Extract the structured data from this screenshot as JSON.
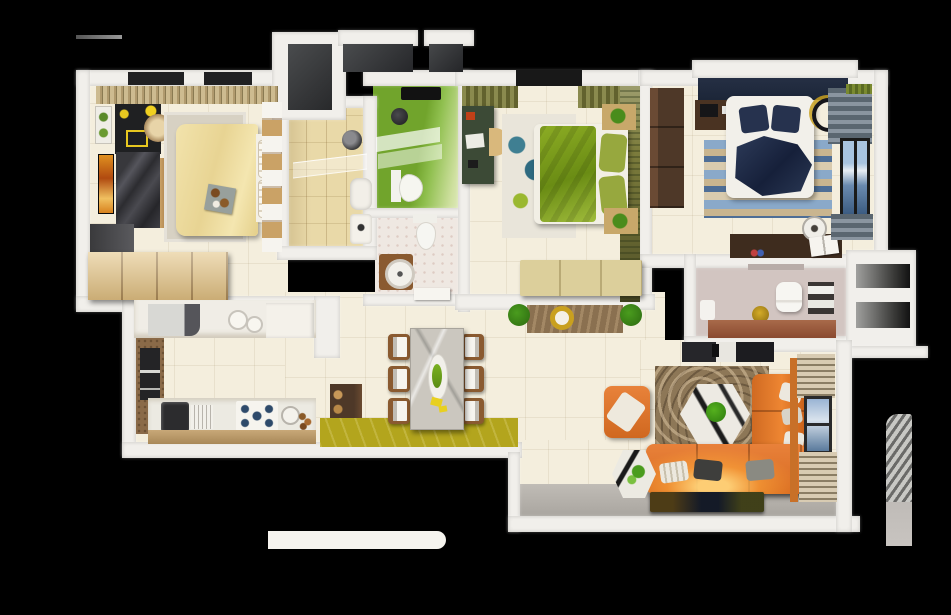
{
  "scene": {
    "kind": "3d-apartment-floorplan-top-view",
    "background_color": "#000000",
    "canvas": {
      "width": 951,
      "height": 615
    },
    "visible_text": "none"
  },
  "palette": {
    "bg": "#000000",
    "wall": "#f1efeb",
    "floor-cream": "#f4eedd",
    "floor-gray": "#b2aeaa",
    "olive-rug": "#b3a51d",
    "slab-dark": "#3b3d3f",
    "navy-slab": "#1c2638",
    "bed1": "#efdfa3",
    "rug1": "#d7d1c3",
    "wood-light": "#e6cb92",
    "wood-tan": "#caa266",
    "wood-mid": "#8a5a30",
    "wood-dark": "#4e3828",
    "wood-deep": "#3e2c1e",
    "black-furn": "#1f2022",
    "marble-dark": "#333336",
    "tv-orange": "#d8821e",
    "bath-tan": "#e9d9a8",
    "green-wall": "#71a42c",
    "toilet-floor": "#efe8e2",
    "desk-green": "#3c4a36",
    "blanket-green": "#7d9c1e",
    "head-olive": "#7c7c3c",
    "bench-khaki": "#dccf9b",
    "nightstand-tan": "#c8a86a",
    "navy-blanket": "#232f4a",
    "curtain-gray": "#76818b",
    "sky-blue": "#8fb0d6",
    "mauve": "#d2c5c1",
    "copper": "#9a5c40",
    "gold": "#c9a01e",
    "sofa-orange": "#e2772a",
    "glow": "#ffb347",
    "living-rug": "#8d7757",
    "marble-white": "#edeae3",
    "white-soft": "#f6f4ef",
    "counter-white": "#f0ede6",
    "curtain-beige": "#cdbb90",
    "blind-tan": "#d8cbb2",
    "plant": "#3f9c1c"
  },
  "rooms": [
    {
      "id": "bedroom-1",
      "position": "top-left",
      "floor": "cream-tile",
      "furniture": [
        "striped-curtain",
        "window-panes",
        "picture-frames",
        "black-dresser",
        "rattan-lamp",
        "marble-tv-unit",
        "wall-tv",
        "area-rug",
        "double-bed-cream",
        "headboard-pillows",
        "breakfast-tray",
        "door-opening",
        "wood-wardrobe",
        "towel-shelf-column"
      ]
    },
    {
      "id": "ensuite-bathroom",
      "position": "top-center-left",
      "floor": "tan-tile",
      "furniture": [
        "shower-head",
        "glass-shelf",
        "bathtub",
        "washbasin"
      ]
    },
    {
      "id": "green-bathroom",
      "position": "top-center",
      "floor": "green-gradient",
      "furniture": [
        "ceiling-vent",
        "round-basin",
        "glass-shelves",
        "toilet"
      ]
    },
    {
      "id": "wc-room",
      "position": "center",
      "floor": "speckled-white",
      "furniture": [
        "toilet",
        "wood-vanity-round-basin",
        "door-leaf"
      ]
    },
    {
      "id": "master-bedroom",
      "position": "top-center-right",
      "floor": "cream-tile",
      "furniture": [
        "curtain-left",
        "window-pane",
        "curtain-right",
        "green-desk",
        "desk-chair",
        "abstract-teal-rug",
        "bed-green-blanket",
        "olive-pillows",
        "nightstand-top-flowers",
        "nightstand-bottom-flowers",
        "textured-headboard-wall",
        "storage-bench"
      ]
    },
    {
      "id": "bedroom-3",
      "position": "top-right",
      "floor": "cream-tile",
      "furniture": [
        "navy-headboard-ledge",
        "dark-wardrobe",
        "study-desk",
        "bed-navy-blanket",
        "navy-pillows",
        "striped-blue-rug",
        "ceiling-fan",
        "gray-curtain-top",
        "side-window-art",
        "writing-desk",
        "kettle",
        "open-book",
        "gray-curtain-bottom",
        "green-curtain-sliver"
      ]
    },
    {
      "id": "bathroom-2",
      "position": "right-center",
      "floor": "mauve",
      "furniture": [
        "wall-mirror",
        "toilet",
        "gold-plant",
        "towel-rack",
        "washbasin",
        "copper-floor-strip"
      ]
    },
    {
      "id": "utility-shaft",
      "position": "right-edge",
      "floor": "dark-void",
      "furniture": [
        "duct-opening-upper",
        "duct-opening-lower"
      ]
    },
    {
      "id": "kitchen",
      "position": "bottom-left",
      "floor": "cream-tile",
      "furniture": [
        "upper-counter",
        "built-in-appliance",
        "plates",
        "upper-cabinet",
        "brown-wall-window",
        "lower-counter",
        "sink",
        "dish-rack",
        "gas-stove-5-burners",
        "mixing-bowl",
        "spice-jars",
        "tan-floor-strip",
        "pantry-cabinet"
      ]
    },
    {
      "id": "dining-area",
      "position": "bottom-center",
      "floor": "cream-tile",
      "furniture": [
        "olive-rug",
        "marble-dining-table",
        "serving-dish",
        "napkins",
        "dining-chairs-x6"
      ]
    },
    {
      "id": "hallway",
      "position": "center",
      "floor": "cream-tile",
      "furniture": [
        "entry-rug",
        "plant-left",
        "plant-right",
        "gold-side-table"
      ]
    },
    {
      "id": "living-room",
      "position": "bottom-right",
      "floor": "cream-tile",
      "furniture": [
        "tv-console",
        "patterned-brown-rug",
        "hex-coffee-table",
        "table-plant",
        "sofa-chaise",
        "sofa-main",
        "sofa-pillows",
        "lamp-glow",
        "armchair",
        "hex-side-table",
        "floor-tv",
        "orange-window-frame",
        "blinds-top",
        "window",
        "blinds-bottom"
      ]
    },
    {
      "id": "terrace",
      "position": "bottom",
      "floor": "gray",
      "furniture": []
    }
  ],
  "exterior_elements": [
    "curtain-rod",
    "loggia-dark-left",
    "ac-slab-a",
    "ac-slab-b",
    "loggia-navy-right",
    "white-rounded-ledge",
    "striped-pillar"
  ]
}
